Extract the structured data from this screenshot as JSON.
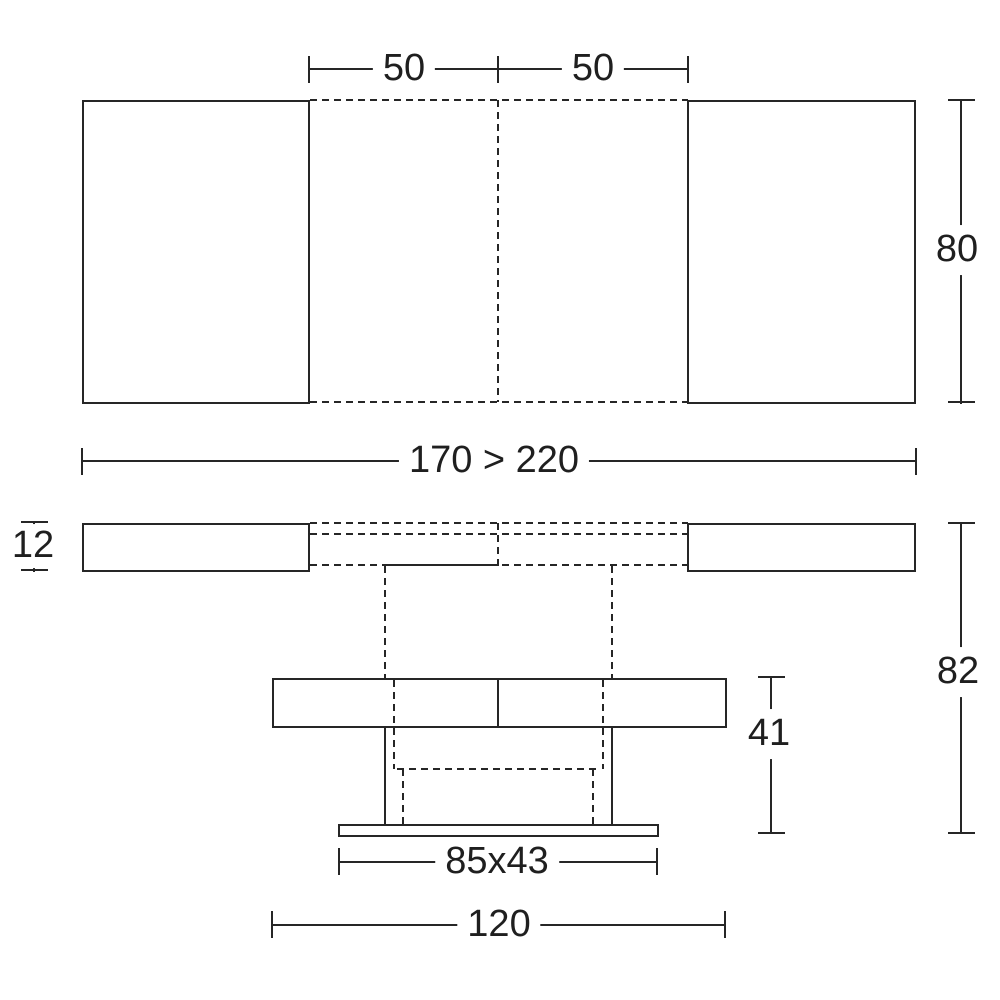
{
  "diagram": {
    "line_color": "#262626",
    "background_color": "#ffffff",
    "dims": {
      "leaf_left": "50",
      "leaf_right": "50",
      "depth": "80",
      "width_range": "170 > 220",
      "top_thickness": "12",
      "total_height": "82",
      "base_height": "41",
      "base_footprint": "85x43",
      "base_width": "120"
    }
  }
}
